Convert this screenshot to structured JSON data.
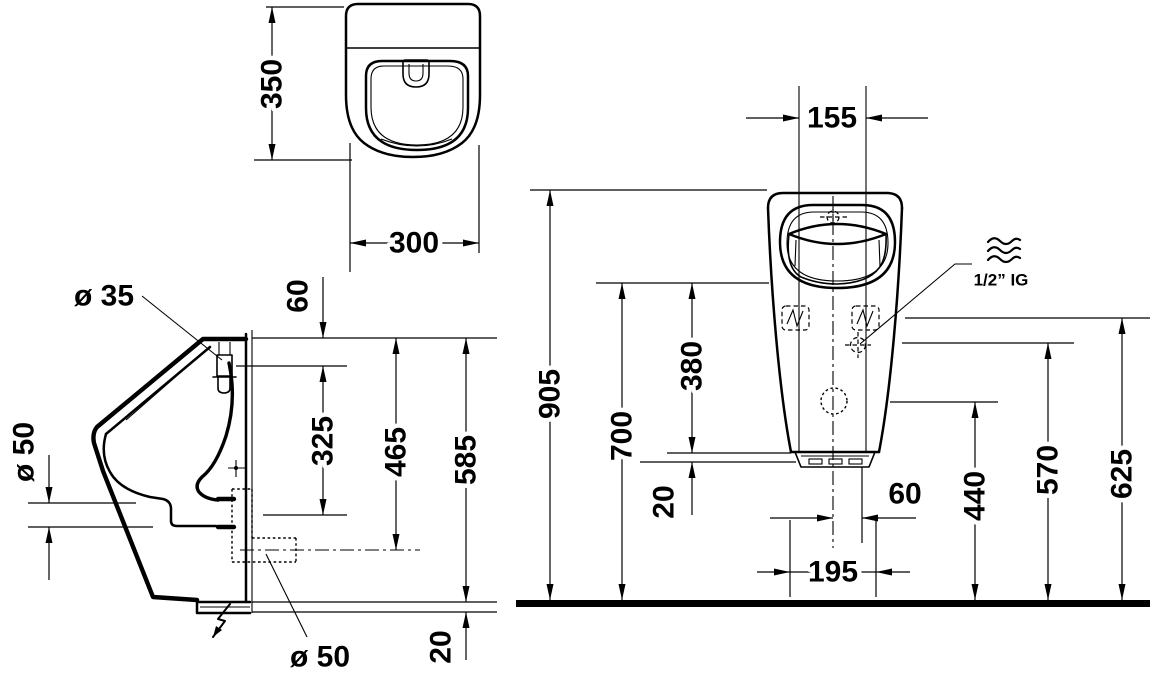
{
  "dimensions": {
    "top_view": {
      "depth": "350",
      "width": "300"
    },
    "side_view": {
      "inlet_diameter": "ø 35",
      "top_to_inlet": "60",
      "inlet_to_outlet": "325",
      "top_to_outlet": "465",
      "height": "585",
      "outlet_diameter": "ø 50",
      "bottom_outlet_diameter": "ø 50",
      "bottom_trim": "20"
    },
    "front_view": {
      "rim_inner_width": "155",
      "top_height": "905",
      "rim_height": "700",
      "rim_to_base": "380",
      "base_detail": "20",
      "center_to_supply": "60",
      "base_width": "195",
      "outlet_height": "440",
      "supply_height": "570",
      "fixing_height": "625",
      "supply_connection": "1/2” IG"
    }
  }
}
